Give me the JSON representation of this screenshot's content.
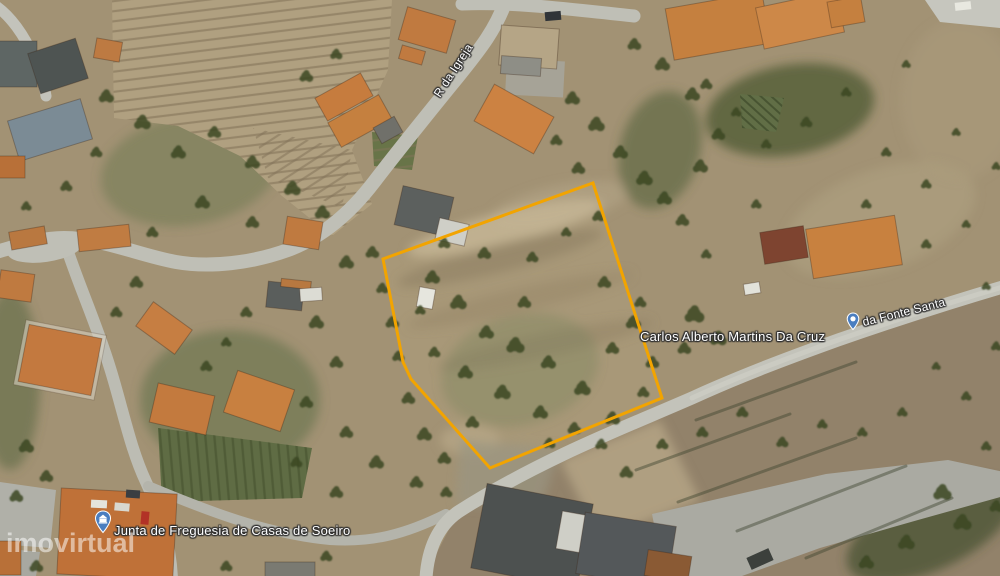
{
  "map": {
    "type": "satellite",
    "watermark": "imovirtual",
    "labels": {
      "street_igreja": "R da Igreja",
      "street_fonte": "da Fonte Santa",
      "place_carlos": "Carlos Alberto Martins Da Cruz",
      "place_junta": "Junta de Freguesia de Casas de Soeiro"
    },
    "property_boundary": {
      "color": "#F2A400",
      "points": "593,183 662,398 490,468 411,379 403,362 383,259"
    },
    "pois": [
      {
        "name": "town-hall",
        "icon": "building-pin",
        "color": "#4A7EC0"
      },
      {
        "name": "fountain",
        "icon": "fountain-pin",
        "color": "#4A7EC0"
      }
    ]
  }
}
